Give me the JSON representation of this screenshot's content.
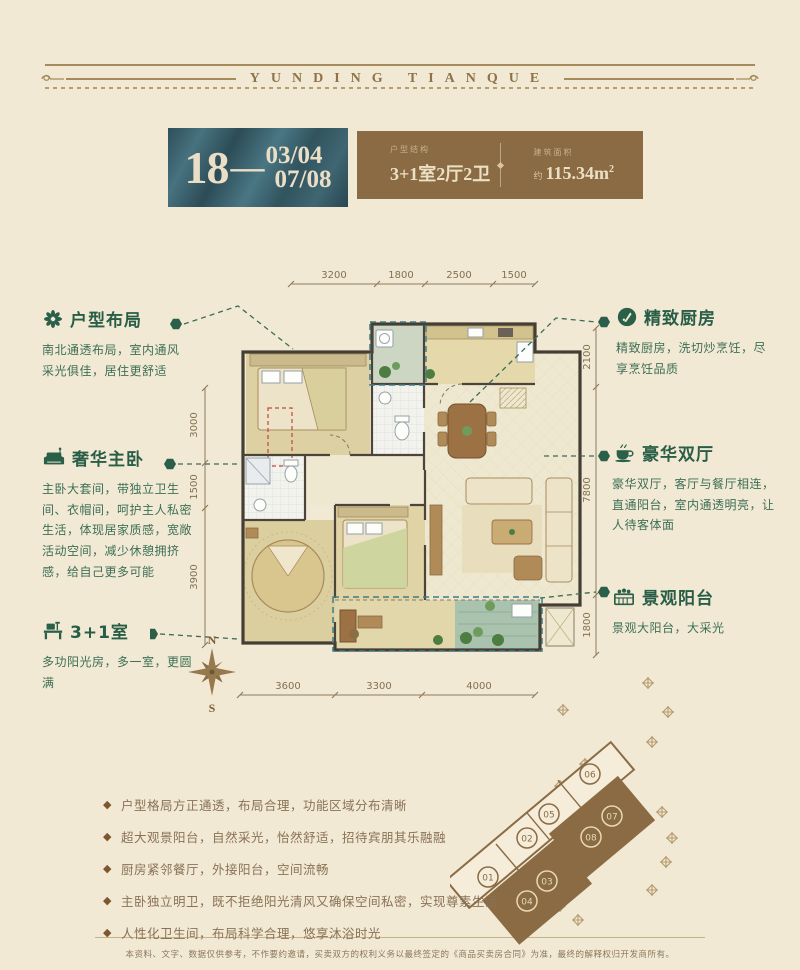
{
  "colors": {
    "teal": "#35586356",
    "teal_box": "#3a5c68",
    "brown": "#8a6b44",
    "green": "#2a5f48",
    "cream": "#f2e9d5",
    "cream_text": "#ece0c4",
    "dim": "#847050"
  },
  "header": {
    "brand": "YUNDING TIANQUE"
  },
  "title_block": {
    "unit_prefix": "18",
    "dash": "—",
    "units_line1": "03/04",
    "units_line2": "07/08",
    "spec_label": "户型结构",
    "spec_value": "3+1室2厅2卫",
    "area_label": "建筑面积",
    "area_prefix": "约",
    "area_value": "115.34m",
    "area_sup": "2"
  },
  "plan": {
    "dims": {
      "top": [
        "3200",
        "1800",
        "2500",
        "1500"
      ],
      "bottom": [
        "3600",
        "3300",
        "4000"
      ],
      "left": [
        "3000",
        "1500",
        "3900"
      ],
      "right": [
        "2100",
        "7800",
        "1800"
      ]
    },
    "compass": {
      "north": "N",
      "south": "S"
    }
  },
  "annotations": {
    "left": [
      {
        "icon": "flower-icon",
        "title": "户型布局",
        "body": "南北通透布局，室内通风采光俱佳，居住更舒适"
      },
      {
        "icon": "sofa-icon",
        "title": "奢华主卧",
        "body": "主卧大套间，带独立卫生间、衣帽间，呵护主人私密生活，体现居家质感，宽敞活动空间，减少休憩拥挤感，给自己更多可能"
      },
      {
        "icon": "desk-icon",
        "title": "3+1室",
        "body": "多功阳光房，多一室，更圆满"
      }
    ],
    "right": [
      {
        "icon": "kitchen-icon",
        "title": "精致厨房",
        "body": "精致厨房，洗切炒烹饪，尽享烹饪品质"
      },
      {
        "icon": "cup-icon",
        "title": "豪华双厅",
        "body": "豪华双厅，客厅与餐厅相连，直通阳台，室内通透明亮，让人待客体面"
      },
      {
        "icon": "balcony-icon",
        "title": "景观阳台",
        "body": "景观大阳台，大采光"
      }
    ]
  },
  "features_bullet": "◆",
  "features": [
    "户型格局方正通透，布局合理，功能区域分布清晰",
    "超大观景阳台，自然采光，怡然舒适，招待宾朋其乐融融",
    "厨房紧邻餐厅，外接阳台，空间流畅",
    "主卧独立明卫，既不拒绝阳光清风又确保空间私密，实现尊素生活",
    "人性化卫生间，布局科学合理，悠享沐浴时光"
  ],
  "site_plan": {
    "units": [
      {
        "no": "01",
        "highlight": false
      },
      {
        "no": "02",
        "highlight": false
      },
      {
        "no": "03",
        "highlight": true
      },
      {
        "no": "04",
        "highlight": true
      },
      {
        "no": "05",
        "highlight": false
      },
      {
        "no": "06",
        "highlight": false
      },
      {
        "no": "07",
        "highlight": true
      },
      {
        "no": "08",
        "highlight": true
      }
    ]
  },
  "footer": {
    "disclaimer": "本资料、文字、数据仅供参考，不作要约邀请，买卖双方的权利义务以最终签定的《商品买卖房合同》为准，最终的解释权归开发商所有。"
  }
}
